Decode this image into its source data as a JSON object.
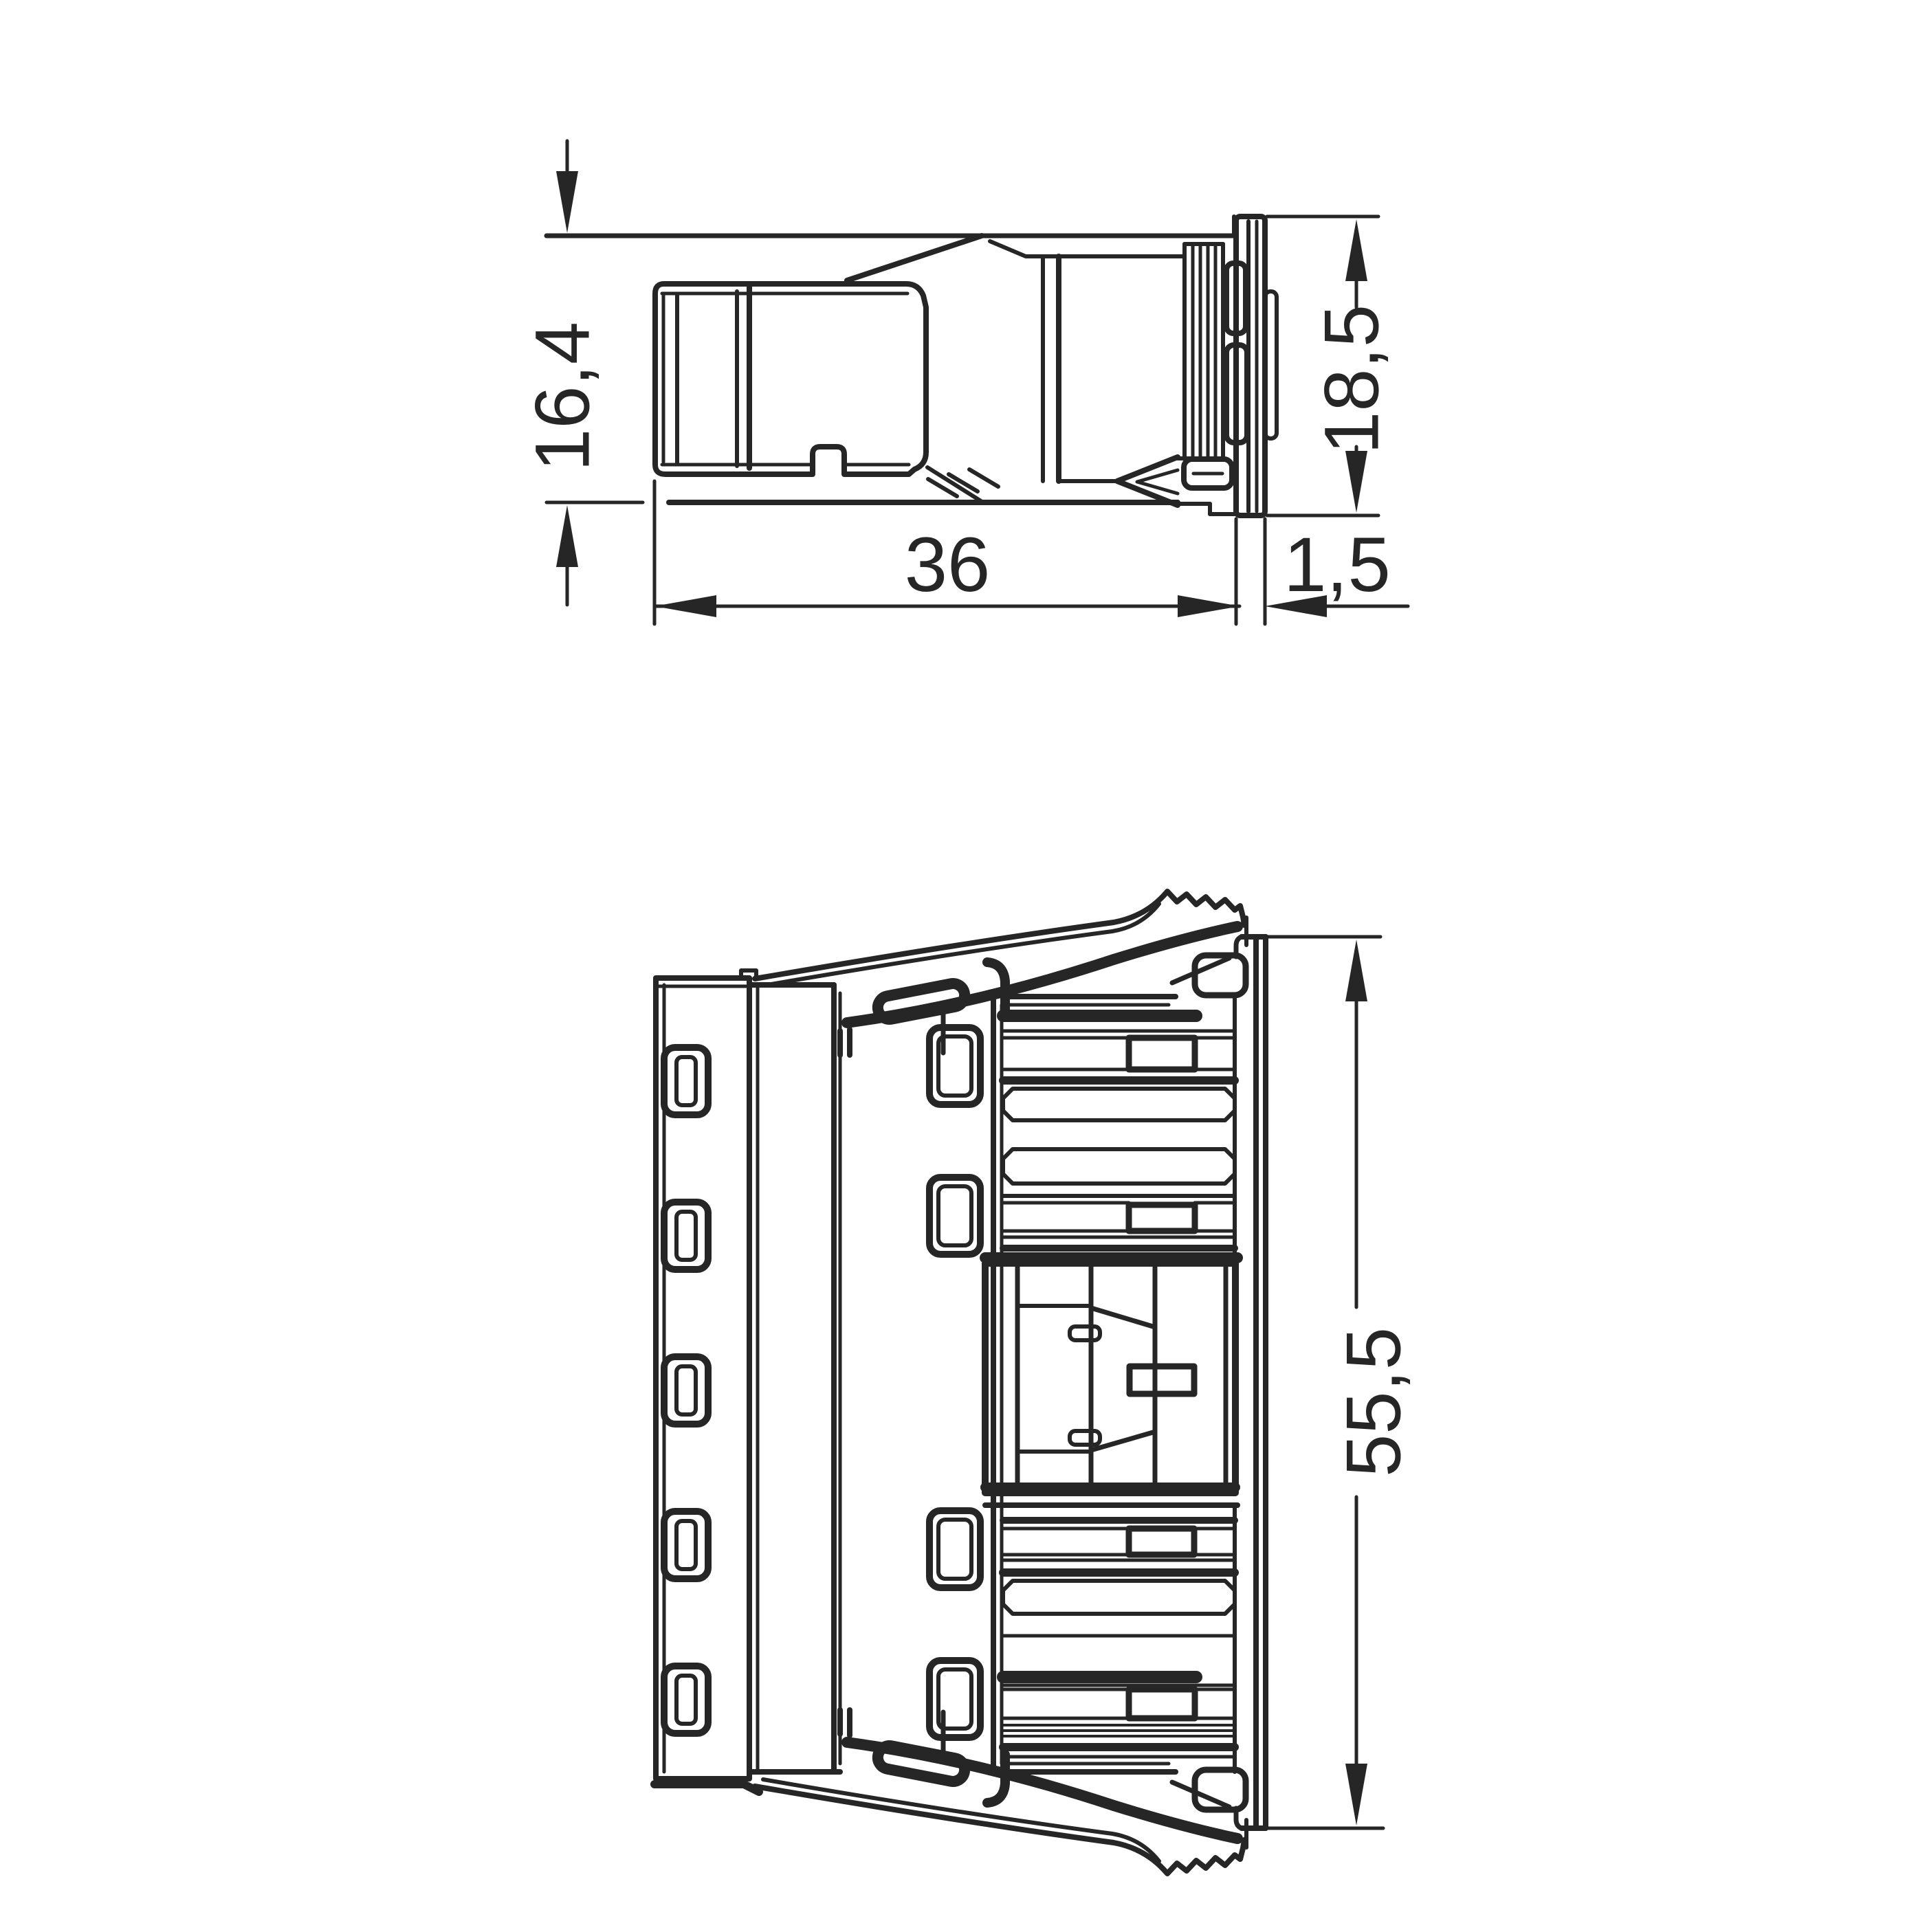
{
  "colors": {
    "ink": "#262626",
    "background": "#ffffff"
  },
  "dimensions": {
    "front_height": "16,4",
    "rear_height": "18,5",
    "length": "36",
    "flange_thickness": "1,5",
    "width": "55,5"
  }
}
